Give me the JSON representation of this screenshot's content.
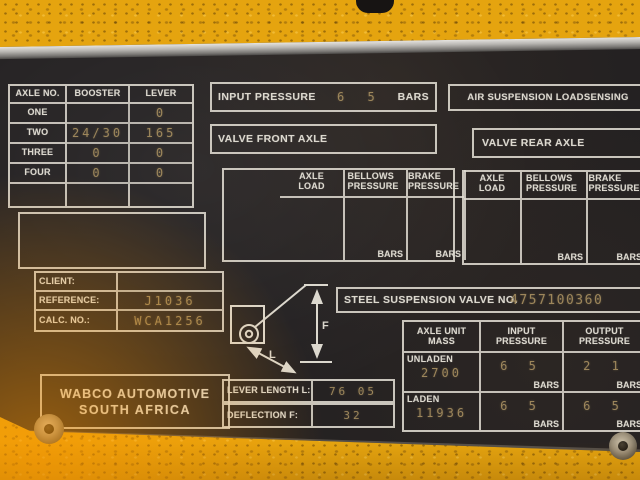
{
  "colors": {
    "machine_yellow": "#e5a40f",
    "plate_black": "#242122",
    "line_white": "#dcd8ce",
    "stamp_tan": "#a78f60"
  },
  "plate": {
    "axle_table": {
      "header": {
        "axle_no": "AXLE NO.",
        "booster": "BOOSTER",
        "lever": "LEVER"
      },
      "rows": [
        {
          "name": "ONE",
          "booster": "",
          "lever": "0"
        },
        {
          "name": "TWO",
          "booster": "24/30",
          "lever": "165"
        },
        {
          "name": "THREE",
          "booster": "0",
          "lever": "0"
        },
        {
          "name": "FOUR",
          "booster": "0",
          "lever": "0"
        }
      ]
    },
    "input_pressure": {
      "label": "INPUT PRESSURE",
      "value": "6 5",
      "unit": "BARS"
    },
    "air_suspension_label": "AIR SUSPENSION LOADSENSING",
    "valve_front_label": "VALVE FRONT AXLE",
    "valve_rear_label": "VALVE REAR AXLE",
    "pressure_table": {
      "axle_load": "AXLE LOAD",
      "bellows": "BELLOWS PRESSURE",
      "brake": "BRAKE PRESSURE",
      "unit": "BARS"
    },
    "client": {
      "label": "CLIENT:",
      "value": ""
    },
    "reference": {
      "label": "REFERENCE:",
      "value": "J1036"
    },
    "calc_no": {
      "label": "CALC. NO.:",
      "value": "WCA1256"
    },
    "steel_valve": {
      "label": "STEEL SUSPENSION VALVE NO.",
      "value": "4757100360"
    },
    "mass_table": {
      "header": {
        "mass": "AXLE UNIT MASS",
        "input": "INPUT PRESSURE",
        "output": "OUTPUT PRESSURE"
      },
      "unit": "BARS",
      "rows": [
        {
          "name": "UNLADEN",
          "mass": "2700",
          "input": "6 5",
          "output": "2 1"
        },
        {
          "name": "LADEN",
          "mass": "11936",
          "input": "6 5",
          "output": "6 5"
        }
      ]
    },
    "lever_length": {
      "label": "LEVER LENGTH L:",
      "value": "76 05"
    },
    "deflection": {
      "label": "DEFLECTION F:",
      "value": "32"
    },
    "diagram": {
      "f": "F",
      "l": "L"
    },
    "manufacturer": {
      "line1": "WABCO AUTOMOTIVE",
      "line2": "SOUTH AFRICA"
    }
  }
}
